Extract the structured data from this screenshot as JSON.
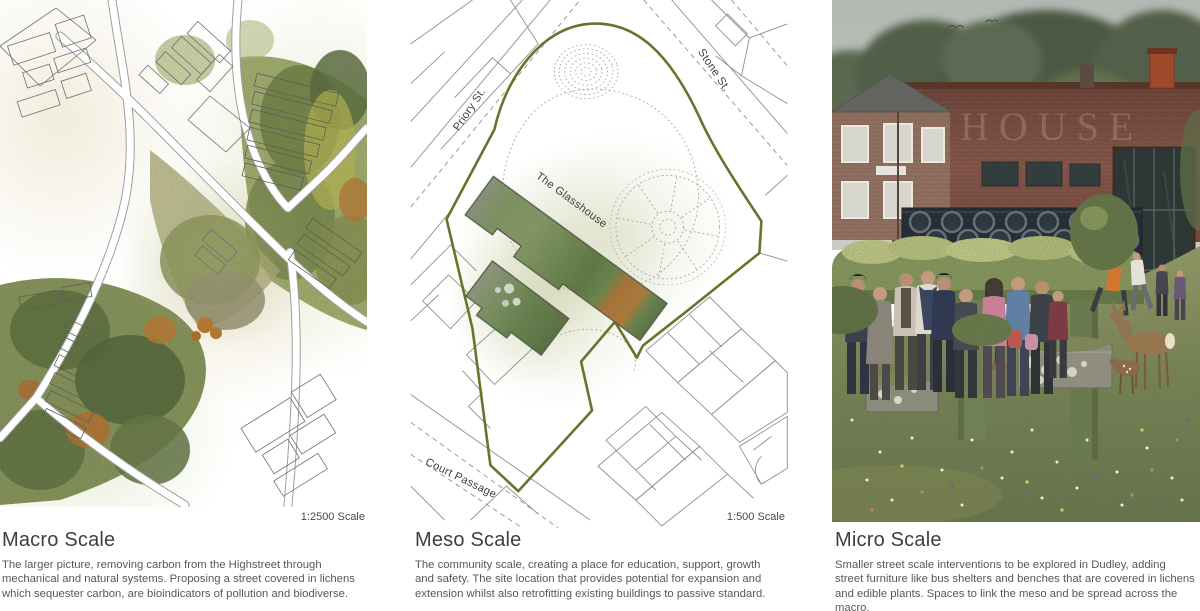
{
  "board": {
    "panels": [
      {
        "key": "macro",
        "title": "Macro Scale",
        "scale_label": "1:2500 Scale",
        "description": "The larger picture, removing carbon from the Highstreet through mechanical and natural systems. Proposing a street covered in lichens which sequester carbon, are bioindicators of pollution and biodiverse."
      },
      {
        "key": "meso",
        "title": "Meso Scale",
        "scale_label": "1:500 Scale",
        "description": "The community scale, creating a place for education, support, growth and safety. The site location that provides potential for expansion and extension whilst also retrofitting existing buildings to passive standard.",
        "labels": {
          "street_priory": "Priory St.",
          "street_stone": "Stone St.",
          "street_court": "Court Passage",
          "building": "The Glasshouse"
        }
      },
      {
        "key": "micro",
        "title": "Micro Scale",
        "description": "Smaller street scale interventions to be explored in Dudley, adding street furniture like bus shelters and benches that are covered in lichens and edible plants. Spaces to link the meso and be spread across the macro.",
        "ghost_sign": "HOUSE"
      }
    ],
    "colors": {
      "site_boundary_olive": "#66742c",
      "map_line_grey": "#8f8f8f",
      "caption_title": "#3b3e42",
      "caption_body": "#55585b"
    }
  }
}
